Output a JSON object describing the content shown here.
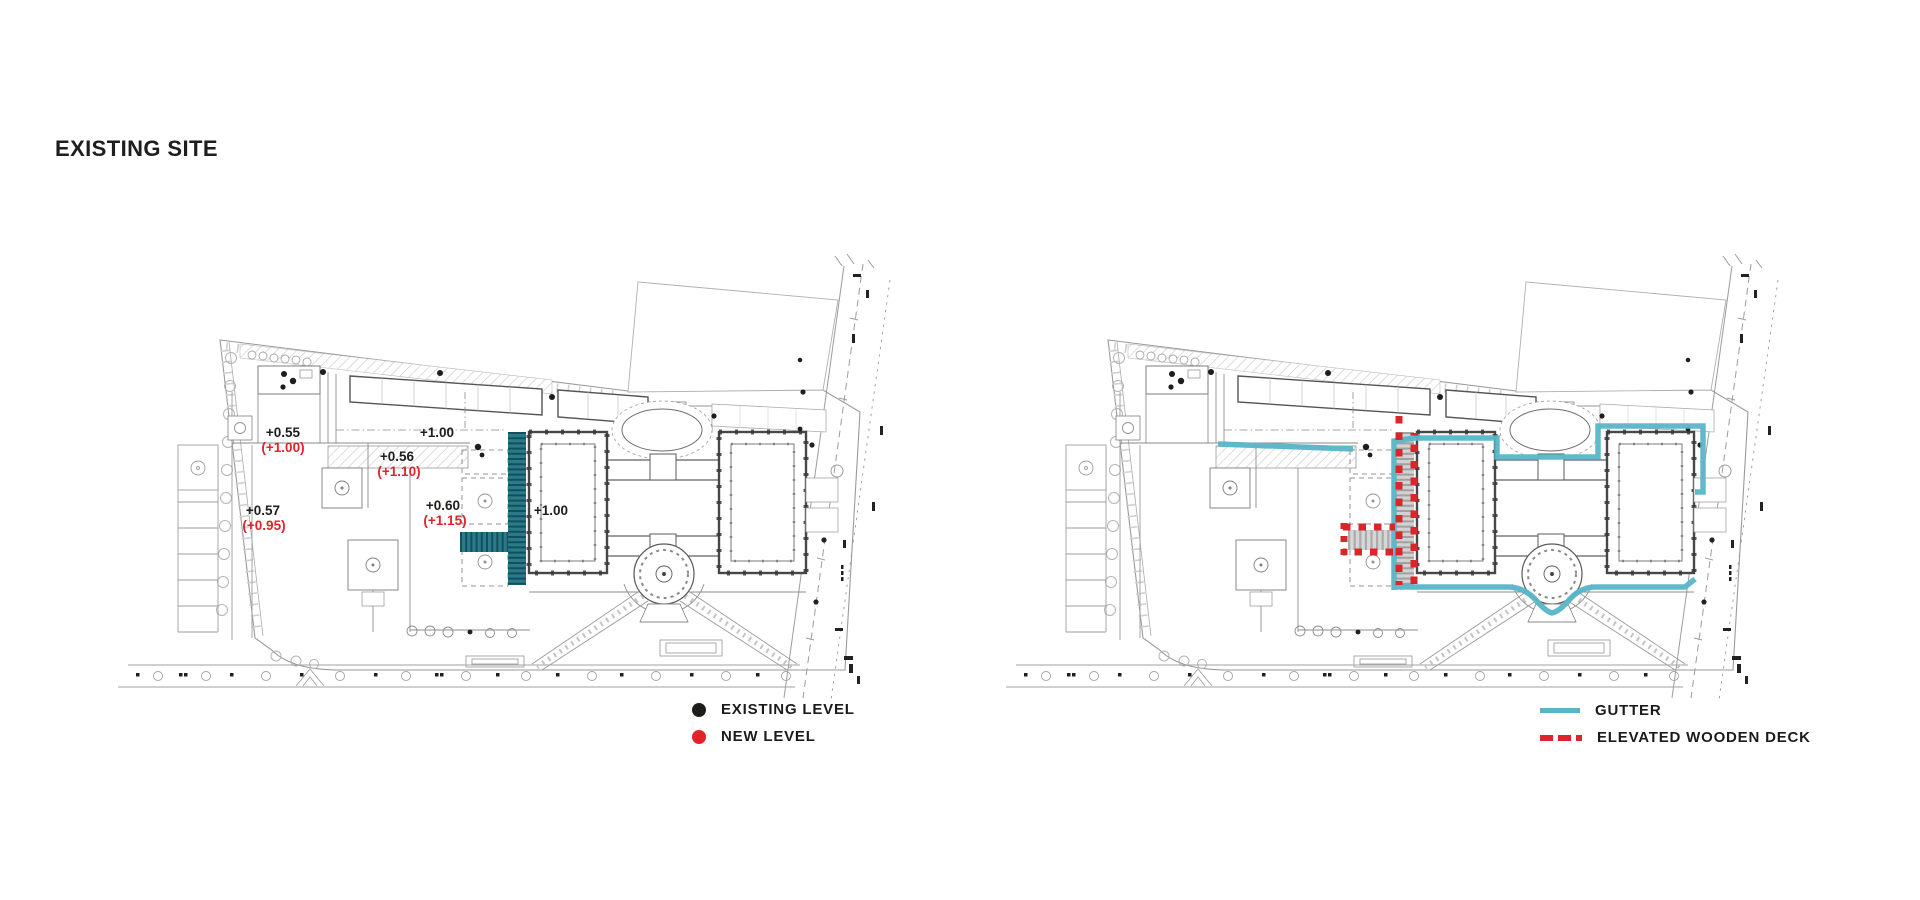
{
  "title": "EXISTING SITE",
  "left_plan": {
    "name": "existing-site-levels-plan",
    "levels": [
      {
        "existing": "+0.55",
        "new": "(+1.00)"
      },
      {
        "existing": "+1.00"
      },
      {
        "existing": "+0.56",
        "new": "(+1.10)"
      },
      {
        "existing": "+0.57",
        "new": "(+0.95)"
      },
      {
        "existing": "+0.60",
        "new": "(+1.15)"
      },
      {
        "existing": "+1.00"
      }
    ],
    "legend": [
      {
        "symbol": "black-dot",
        "color": "#1d1d1b",
        "label": "EXISTING LEVEL"
      },
      {
        "symbol": "red-dot",
        "color": "#e3222a",
        "label": "NEW LEVEL"
      }
    ]
  },
  "right_plan": {
    "name": "gutter-and-elevated-deck-plan",
    "legend": [
      {
        "symbol": "teal-line",
        "color": "#58b6c8",
        "label": "GUTTER"
      },
      {
        "symbol": "red-dashed-line",
        "color": "#d8262b",
        "label": "ELEVATED WOODEN DECK"
      }
    ]
  },
  "colors": {
    "background": "#ffffff",
    "drawing_line": "#8c8c8c",
    "building_wall": "#474747",
    "stairs_teal": "#2a7a89",
    "gutter_teal": "#58b6c8",
    "accent_red": "#d8262b",
    "level_black": "#1d1d1b",
    "level_red": "#e3222a"
  }
}
